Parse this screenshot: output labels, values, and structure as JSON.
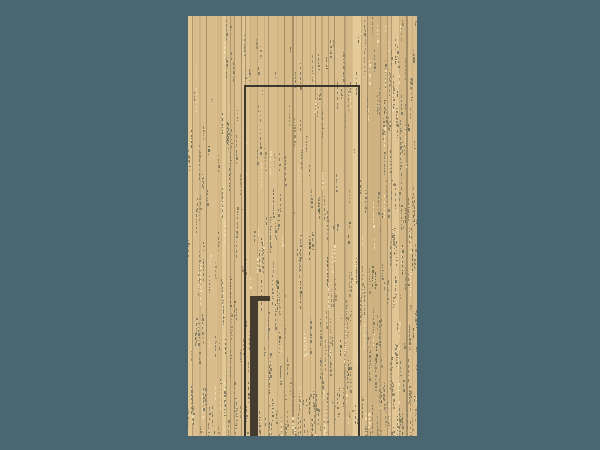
{
  "meta": {
    "type": "game-scene",
    "description": "Minimalist pixel-art scene: a pale wooden slat wall centered on a slate-teal background, with a dark door frame outline reaching the floor and a dark vertical door handle bar with a short horizontal top, weathered speckling densest toward the bottom-right"
  },
  "canvas": {
    "width": 600,
    "height": 450,
    "background_color": "#4a6671"
  },
  "wall": {
    "x": 188,
    "y": 16,
    "width": 229,
    "height": 420,
    "base_color": "#d9bd8c",
    "plank_line_colors": [
      "#bfa776",
      "#b09870",
      "#c9b07e",
      "#a68f66"
    ],
    "plank_tint_colors": [
      "#e6cc9b",
      "#d2b583",
      "#e0c592",
      "#cdb181"
    ],
    "speckle_colors": [
      "#8a8066",
      "#a08d68",
      "#efd9ab",
      "#75704f"
    ],
    "texture_seed": 1337
  },
  "door": {
    "frame": {
      "x": 244,
      "y": 85,
      "width": 116,
      "height": 351,
      "line_color": "#3d362c",
      "line_width": 2
    },
    "handle": {
      "bar_x": 250,
      "bar_y": 296,
      "bar_width": 8,
      "bar_height": 140,
      "top_width": 20,
      "top_height": 5,
      "color": "#453c30"
    }
  }
}
